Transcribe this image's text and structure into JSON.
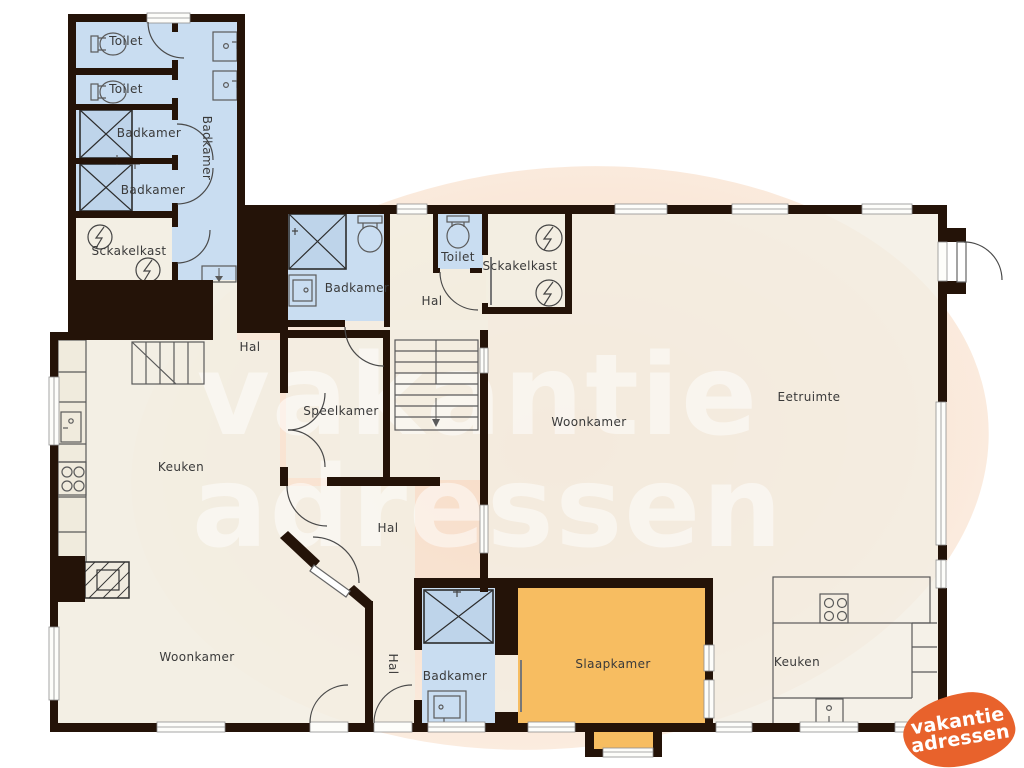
{
  "watermark": {
    "line1": "vakantie",
    "line2": "adressen"
  },
  "logo": {
    "line1": "vakantie",
    "line2": "adressen"
  },
  "palette": {
    "wall": "#241308",
    "floor_beige": "#f2eee2",
    "floor_blue": "#c9ddf1",
    "shower_blue": "#bed4ea",
    "floor_orange": "#f7bd61",
    "watermark_blob": "#f8e0cd",
    "logo_orange": "#e8622c",
    "label_text": "#3a3a3a",
    "fixture_line": "#555555"
  },
  "icons": {
    "toilet": "toilet-icon",
    "sink": "sink-icon",
    "shower": "shower-icon",
    "stove": "stove-icon",
    "lightning": "lightning-icon",
    "stairs": "stairs-icon",
    "door": "door-arc-icon",
    "window": "window-icon"
  },
  "rooms": {
    "toilet_nw_1": {
      "label": "Toilet"
    },
    "toilet_nw_2": {
      "label": "Toilet"
    },
    "badkamer_nw_1": {
      "label": "Badkamer"
    },
    "badkamer_nw_2": {
      "label": "Badkamer"
    },
    "badkamer_nw_hall": {
      "label": "Badkamer"
    },
    "schakelkast_nw": {
      "label": "Sckakelkast"
    },
    "badkamer_n": {
      "label": "Badkamer"
    },
    "hal_n": {
      "label": "Hal"
    },
    "toilet_n": {
      "label": "Toilet"
    },
    "schakelkast_c": {
      "label": "Sckakelkast"
    },
    "hal_w": {
      "label": "Hal"
    },
    "speelkamer": {
      "label": "Speelkamer"
    },
    "keuken_w": {
      "label": "Keuken"
    },
    "woonkamer_c": {
      "label": "Woonkamer"
    },
    "eetruimte": {
      "label": "Eetruimte"
    },
    "hal_c": {
      "label": "Hal"
    },
    "woonkamer_sw": {
      "label": "Woonkamer"
    },
    "hal_s": {
      "label": "Hal"
    },
    "badkamer_s": {
      "label": "Badkamer"
    },
    "slaapkamer": {
      "label": "Slaapkamer"
    },
    "keuken_se": {
      "label": "Keuken"
    }
  }
}
